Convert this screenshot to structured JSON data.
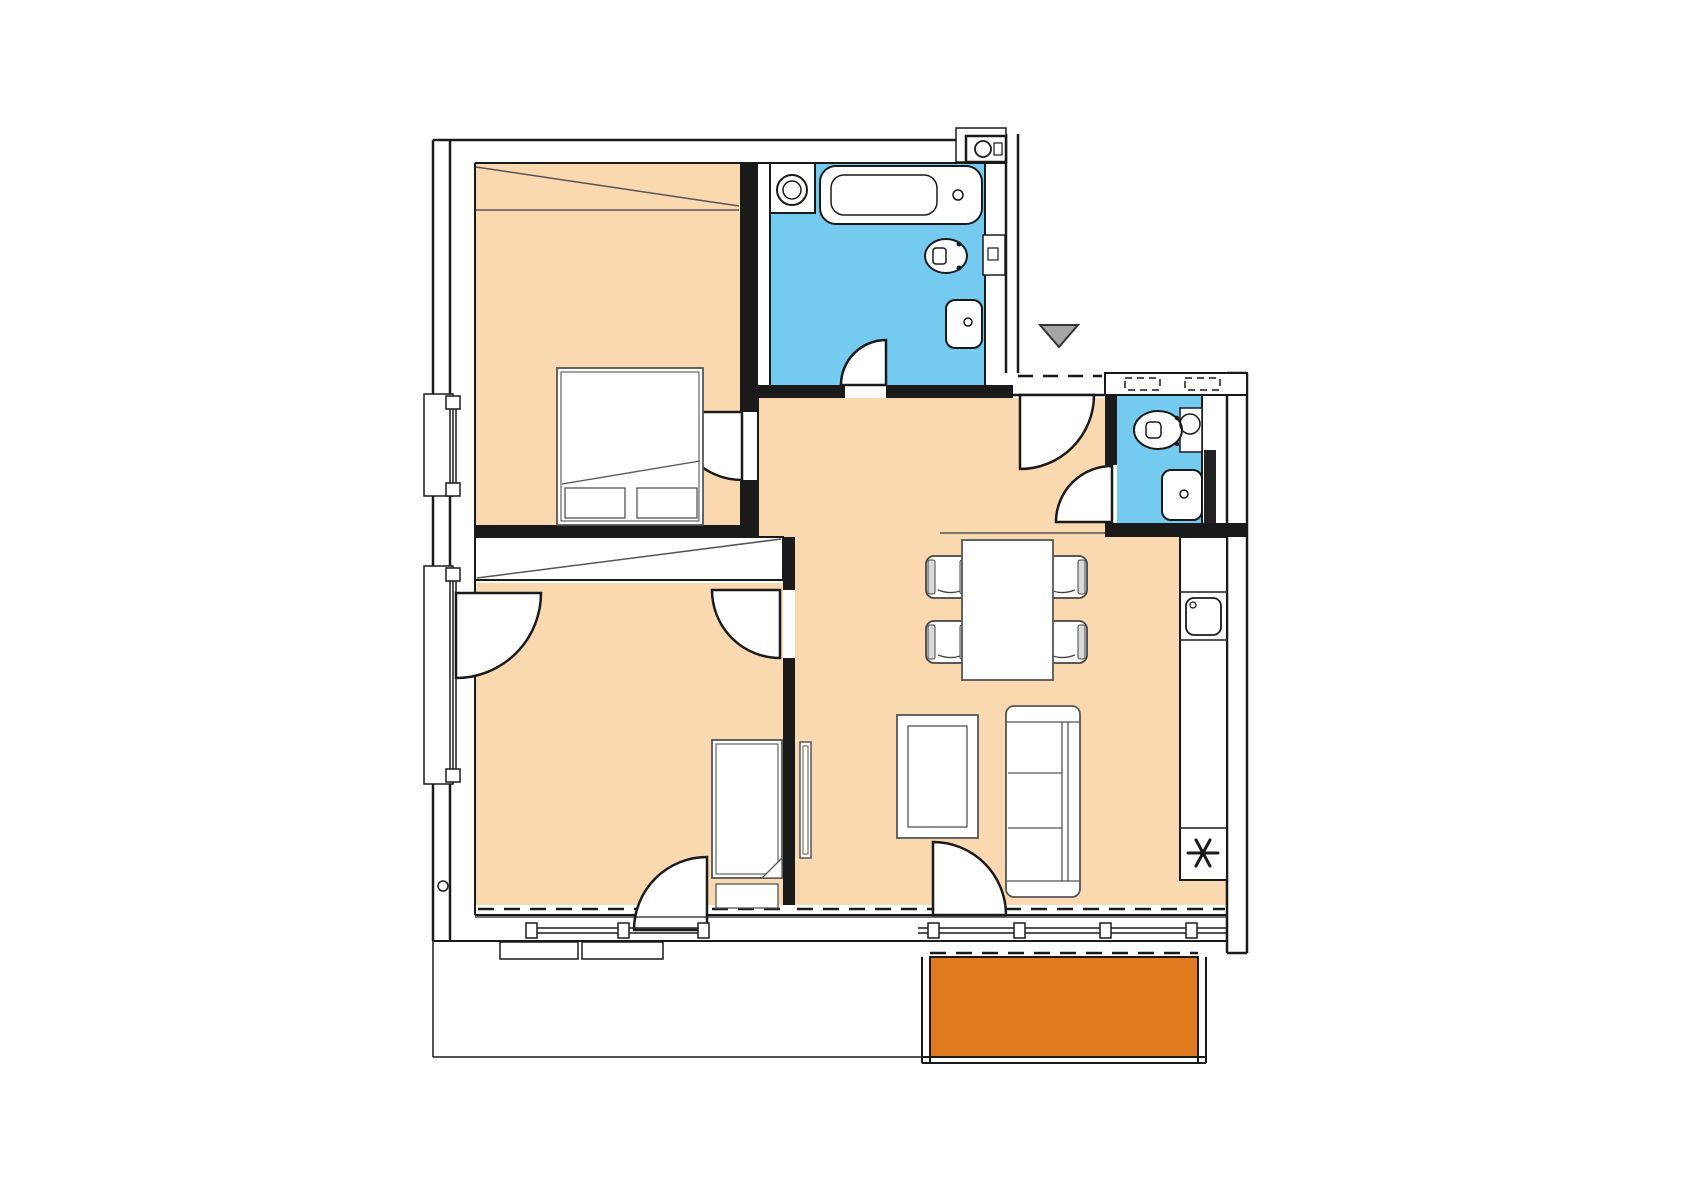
{
  "title": "Apartment floor plan",
  "colors": {
    "floor": "#FAD8B0",
    "wet_room": "#74CBEF",
    "balcony": "#DF7A20",
    "entrance_marker": "#A5A5A5",
    "wall": "#1a1a1a",
    "furniture_line": "#555555"
  },
  "rooms": [
    {
      "id": "bedroom-1",
      "fill": "floor"
    },
    {
      "id": "bedroom-2",
      "fill": "floor"
    },
    {
      "id": "hall",
      "fill": "floor"
    },
    {
      "id": "living-dining",
      "fill": "floor"
    },
    {
      "id": "bathroom",
      "fill": "wet_room"
    },
    {
      "id": "wc",
      "fill": "wet_room"
    },
    {
      "id": "balcony",
      "fill": "balcony"
    }
  ],
  "fixtures": [
    "washing-machine",
    "bathtub",
    "toilet-bathroom",
    "sink-bathroom",
    "toilet-wc",
    "sink-wc",
    "kitchen-counter",
    "kitchen-sink",
    "cooktop",
    "dining-table",
    "dining-chairs",
    "sofa",
    "coffee-table",
    "tv-board",
    "double-bed",
    "single-bed",
    "wardrobe-bedroom-1",
    "wardrobe-bedroom-2"
  ],
  "symbols": {
    "entrance_marker": "triangle-down",
    "cooktop": "six-spoke-asterisk"
  }
}
